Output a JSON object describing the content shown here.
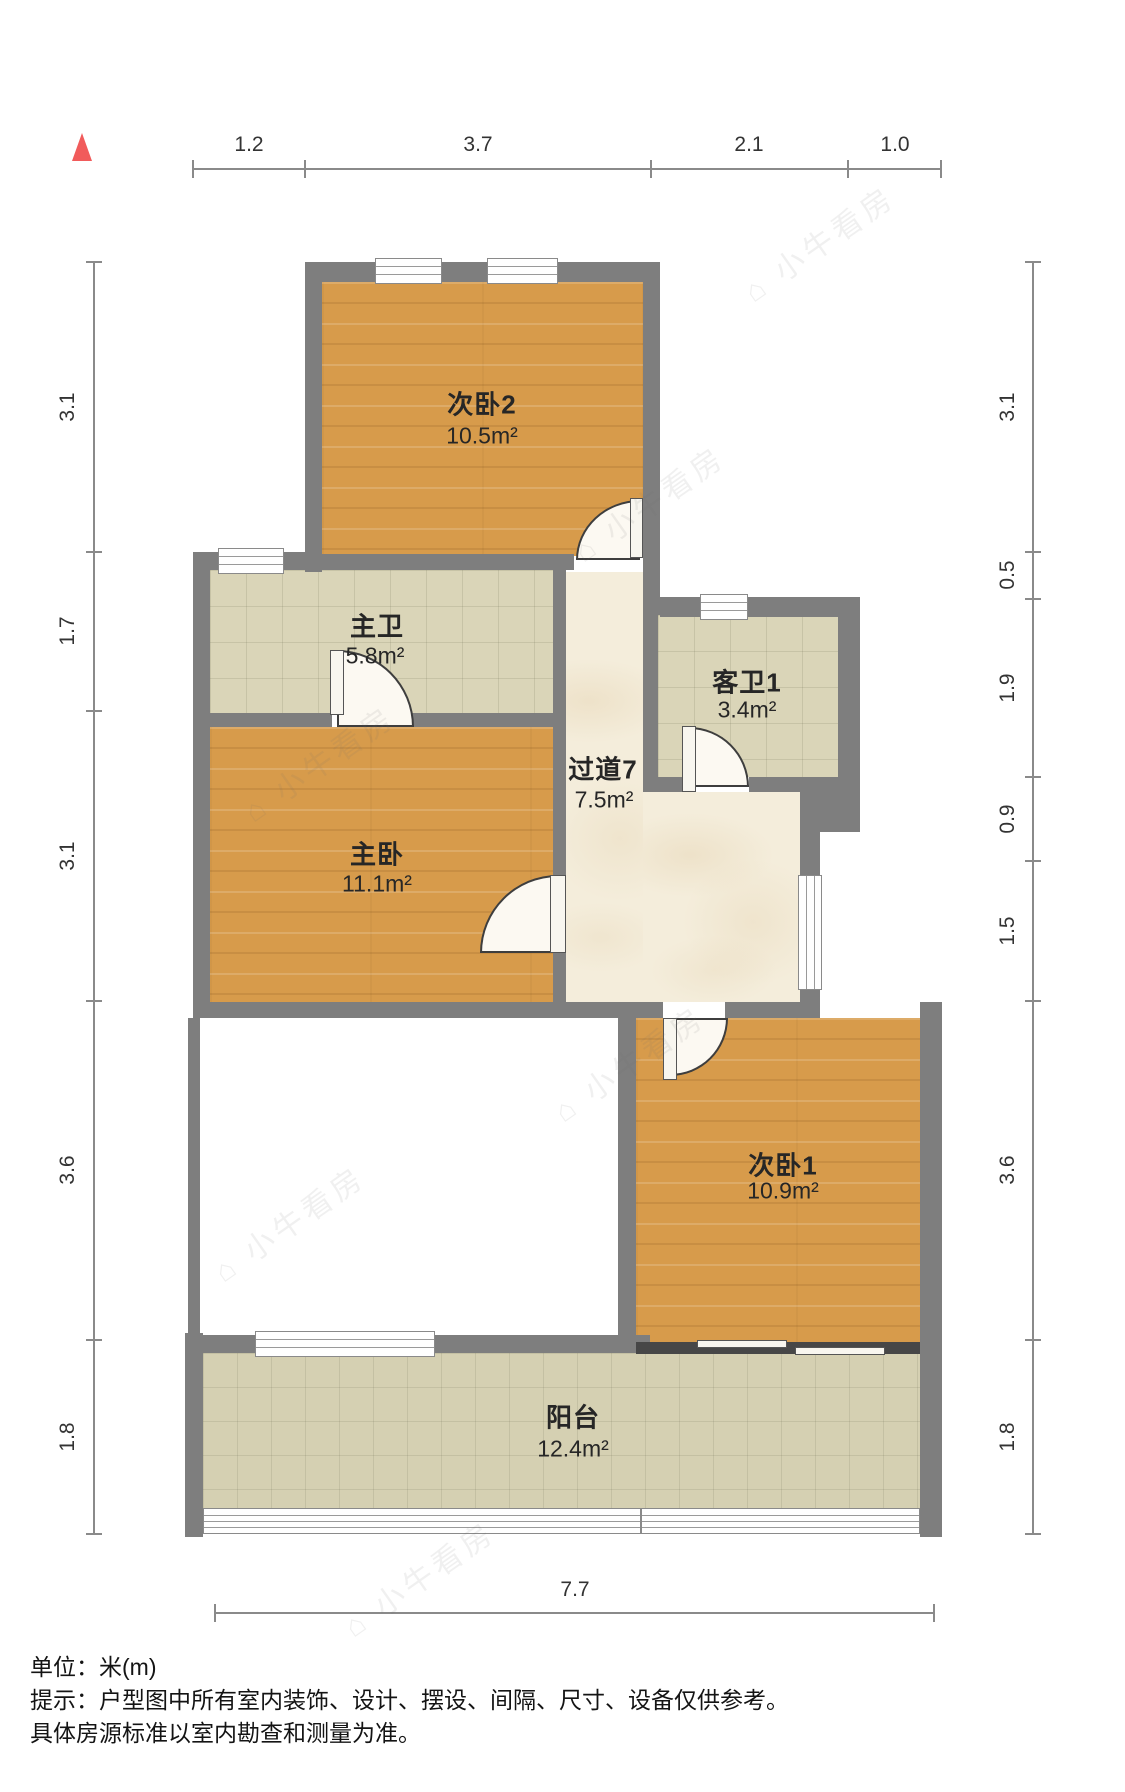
{
  "rooms": {
    "bedroom2": {
      "name": "次卧2",
      "area": "10.5m²"
    },
    "master_bath": {
      "name": "主卫",
      "area": "5.8m²"
    },
    "guest_bath": {
      "name": "客卫1",
      "area": "3.4m²"
    },
    "hallway": {
      "name": "过道7",
      "area": "7.5m²"
    },
    "master_bedroom": {
      "name": "主卧",
      "area": "11.1m²"
    },
    "bedroom1": {
      "name": "次卧1",
      "area": "10.9m²"
    },
    "balcony": {
      "name": "阳台",
      "area": "12.4m²"
    }
  },
  "dimensions": {
    "top": [
      "1.2",
      "3.7",
      "2.1",
      "1.0"
    ],
    "left": [
      "3.1",
      "1.7",
      "3.1",
      "3.6",
      "1.8"
    ],
    "right": [
      "3.1",
      "0.5",
      "1.9",
      "0.9",
      "1.5",
      "3.6",
      "1.8"
    ],
    "bottom": [
      "7.7"
    ]
  },
  "footer": {
    "unit_label": "单位：米(m)",
    "tip_line1": "提示：户型图中所有室内装饰、设计、摆设、间隔、尺寸、设备仅供参考。",
    "tip_line2": "具体房源标准以室内勘查和测量为准。"
  },
  "watermark": {
    "text": "⌂ 小牛看房"
  },
  "colors": {
    "wall": "#7E7E7E",
    "wood_floor": "#D79B4B",
    "bath_tile": "#DAD5B8",
    "marble": "#F4EDDB",
    "balcony_tile": "#D5D0B2",
    "north_arrow": "#F15B5B",
    "dimension_line": "#8A8A8A"
  }
}
